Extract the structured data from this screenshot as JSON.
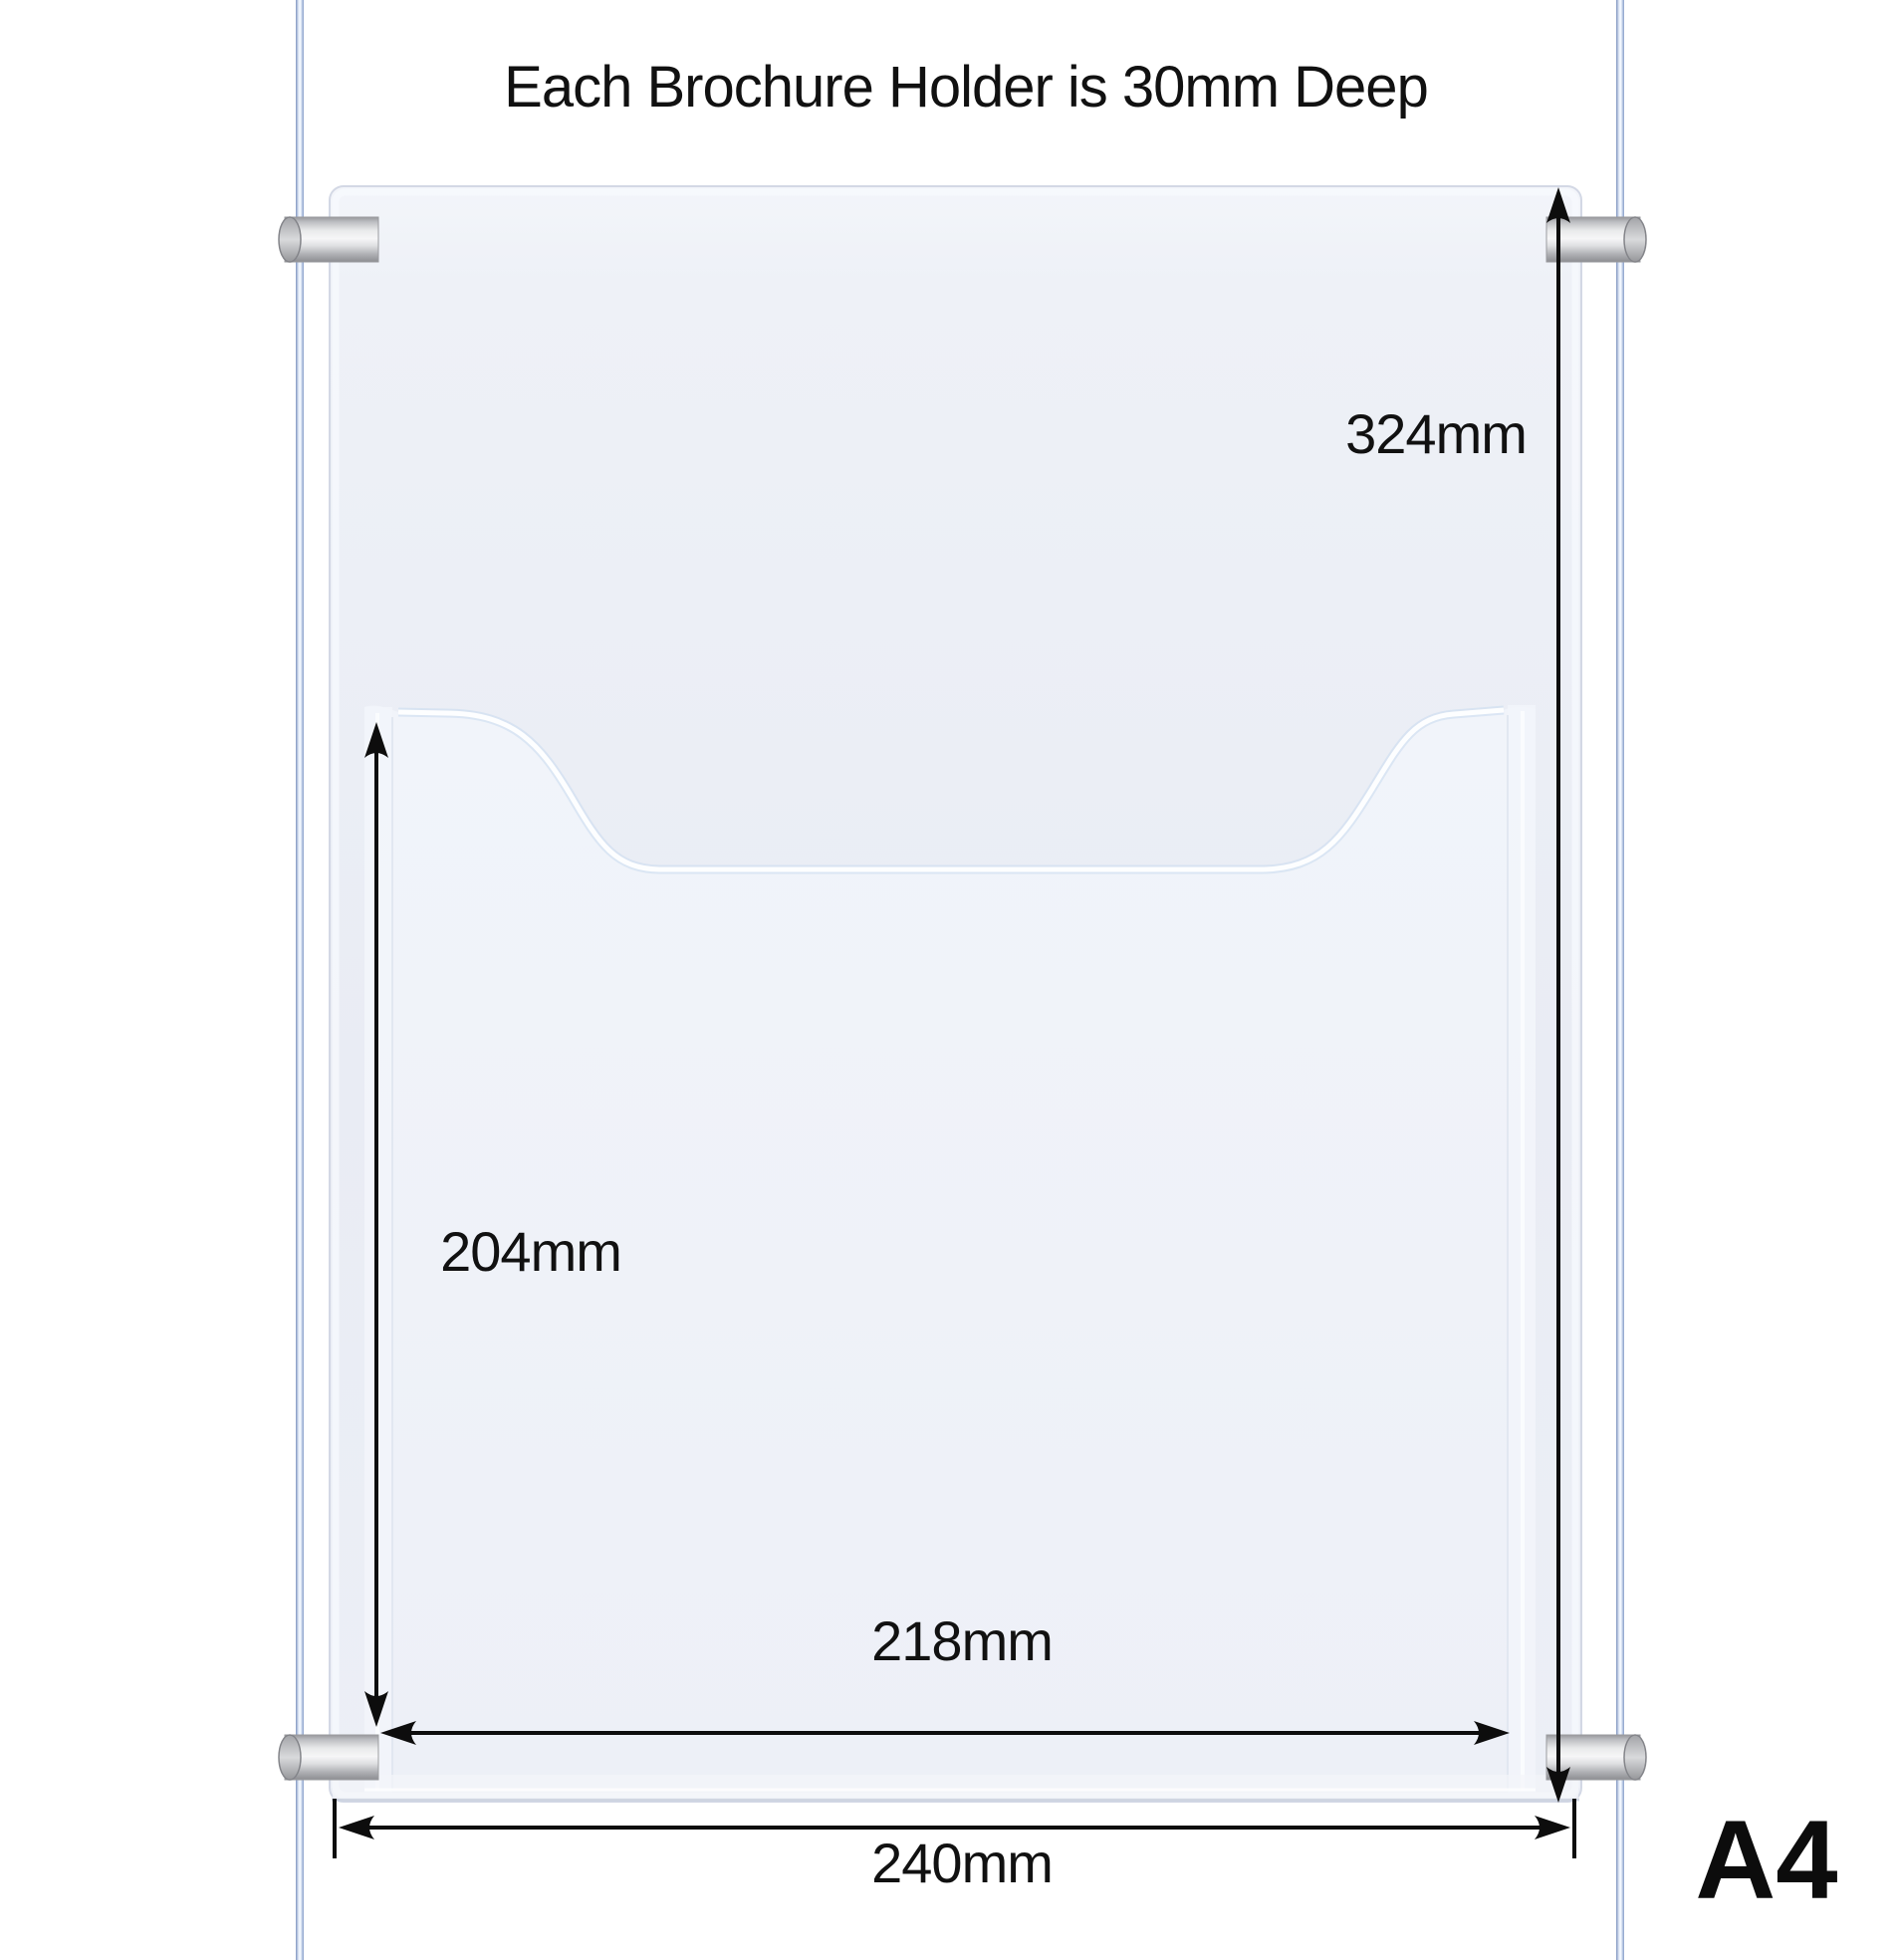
{
  "title": "Each Brochure Holder is 30mm Deep",
  "paper_size_label": "A4",
  "dimensions": {
    "overall_height": "324mm",
    "pocket_height": "204mm",
    "pocket_width": "218mm",
    "overall_width": "240mm"
  },
  "colors": {
    "background": "#ffffff",
    "panel_fill": "#eceff6",
    "pocket_fill": "#f0f3f9",
    "panel_border": "#d3d8e5",
    "cable": "#8aa0c8",
    "metal_light": "#f5f5f6",
    "metal_dark": "#909195",
    "dimension_line": "#0d0d0d",
    "text": "#111111"
  }
}
